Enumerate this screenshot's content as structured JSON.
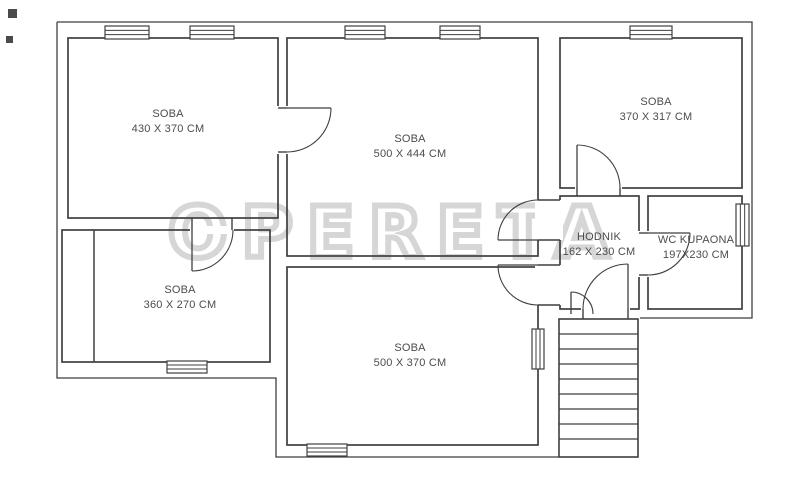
{
  "watermark": {
    "text": "OPERETA",
    "color": "#d6d6d6"
  },
  "plan": {
    "background_color": "#ffffff",
    "wall_color": "#3f3f3f",
    "label_color": "#4c4c4c",
    "rooms": [
      {
        "label": "SOBA",
        "dims": "430 X 370 CM",
        "x": 68,
        "y": 38,
        "w": 210,
        "h": 180,
        "label_cx": 168,
        "label_cy": 122
      },
      {
        "label": "SOBA",
        "dims": "500 X 444 CM",
        "x": 287,
        "y": 38,
        "w": 251,
        "h": 218,
        "label_cx": 410,
        "label_cy": 147
      },
      {
        "label": "SOBA",
        "dims": "370 X 317 CM",
        "x": 560,
        "y": 38,
        "w": 182,
        "h": 150,
        "label_cx": 656,
        "label_cy": 110
      },
      {
        "label": "SOBA",
        "dims": "360 X 270 CM",
        "x": 62,
        "y": 230,
        "w": 208,
        "h": 132,
        "label_cx": 180,
        "label_cy": 298
      },
      {
        "label": "SOBA",
        "dims": "500 X 370 CM",
        "x": 287,
        "y": 267,
        "w": 251,
        "h": 178,
        "label_cx": 410,
        "label_cy": 356
      },
      {
        "label": "HODNIK",
        "dims": "162 X 230 CM",
        "x": 560,
        "y": 196,
        "w": 79,
        "h": 113,
        "label_cx": 599,
        "label_cy": 245
      },
      {
        "label": "WC KUPAONA",
        "dims": "197X230 CM",
        "x": 648,
        "y": 196,
        "w": 94,
        "h": 113,
        "label_cx": 696,
        "label_cy": 248
      }
    ],
    "outline_paths": [
      "M57,22 H752 V318 H640",
      "M57,22 V378 H276 V457 H559"
    ],
    "inner_lines": [
      "M94,230 V362"
    ],
    "windows": [
      {
        "x": 105,
        "y": 26,
        "w": 44,
        "h": 13,
        "orient": "h"
      },
      {
        "x": 190,
        "y": 26,
        "w": 44,
        "h": 13,
        "orient": "h"
      },
      {
        "x": 345,
        "y": 26,
        "w": 40,
        "h": 13,
        "orient": "h"
      },
      {
        "x": 440,
        "y": 26,
        "w": 40,
        "h": 13,
        "orient": "h"
      },
      {
        "x": 630,
        "y": 26,
        "w": 42,
        "h": 13,
        "orient": "h"
      },
      {
        "x": 736,
        "y": 204,
        "w": 13,
        "h": 42,
        "orient": "v"
      },
      {
        "x": 167,
        "y": 361,
        "w": 40,
        "h": 12,
        "orient": "h"
      },
      {
        "x": 307,
        "y": 444,
        "w": 40,
        "h": 12,
        "orient": "h"
      },
      {
        "x": 532,
        "y": 329,
        "w": 12,
        "h": 40,
        "orient": "v"
      }
    ],
    "wall_openings": [
      {
        "x": 274,
        "y": 106,
        "w": 17,
        "h": 48
      },
      {
        "x": 190,
        "y": 226,
        "w": 44,
        "h": 8
      },
      {
        "x": 575,
        "y": 185,
        "w": 47,
        "h": 7
      },
      {
        "x": 535,
        "y": 200,
        "w": 28,
        "h": 40
      },
      {
        "x": 535,
        "y": 265,
        "w": 28,
        "h": 40
      },
      {
        "x": 581,
        "y": 306,
        "w": 49,
        "h": 7
      },
      {
        "x": 636,
        "y": 231,
        "w": 14,
        "h": 46
      }
    ],
    "jamb_lines": [
      "M278,108 H287",
      "M278,152 H287",
      "M192,218 V230",
      "M232,218 V230",
      "M577,188 V196",
      "M620,188 V196",
      "M538,200 H560",
      "M538,240 H560",
      "M538,265 H560",
      "M538,305 H560",
      "M583,309 V319",
      "M628,309 V319",
      "M639,233 H648",
      "M639,275 H648"
    ],
    "doors": [
      {
        "leaf": "M287,108 H331",
        "arc": "M331,108 A44,44 0 0 1 287,152"
      },
      {
        "leaf": "M192,230 V271",
        "arc": "M192,271 A41,41 0 0 0 233,230"
      },
      {
        "leaf": "M577,188 V145",
        "arc": "M577,145 A43,43 0 0 1 620,188"
      },
      {
        "leaf": "M538,240 H498",
        "arc": "M498,240 A40,40 0 0 1 538,200"
      },
      {
        "leaf": "M538,265 H498",
        "arc": "M498,265 A40,40 0 0 0 538,305"
      },
      {
        "leaf": "M628,309 V264",
        "arc": "M628,264 A45,45 0 0 0 583,309"
      },
      {
        "leaf": "M571,314 V292",
        "arc": "M571,292 A22,22 0 0 1 593,314"
      },
      {
        "leaf": "M648,233 H690",
        "arc": "M690,233 A42,42 0 0 1 648,275"
      }
    ],
    "stairs": {
      "x": 559,
      "y": 319,
      "w": 79,
      "h": 138,
      "tread_ys": [
        334,
        349,
        364,
        379,
        394,
        409,
        424,
        439
      ]
    },
    "corner_marks": [
      {
        "x": 8,
        "y": 9,
        "w": 9,
        "h": 9
      },
      {
        "x": 6,
        "y": 36,
        "w": 7,
        "h": 7
      }
    ]
  }
}
